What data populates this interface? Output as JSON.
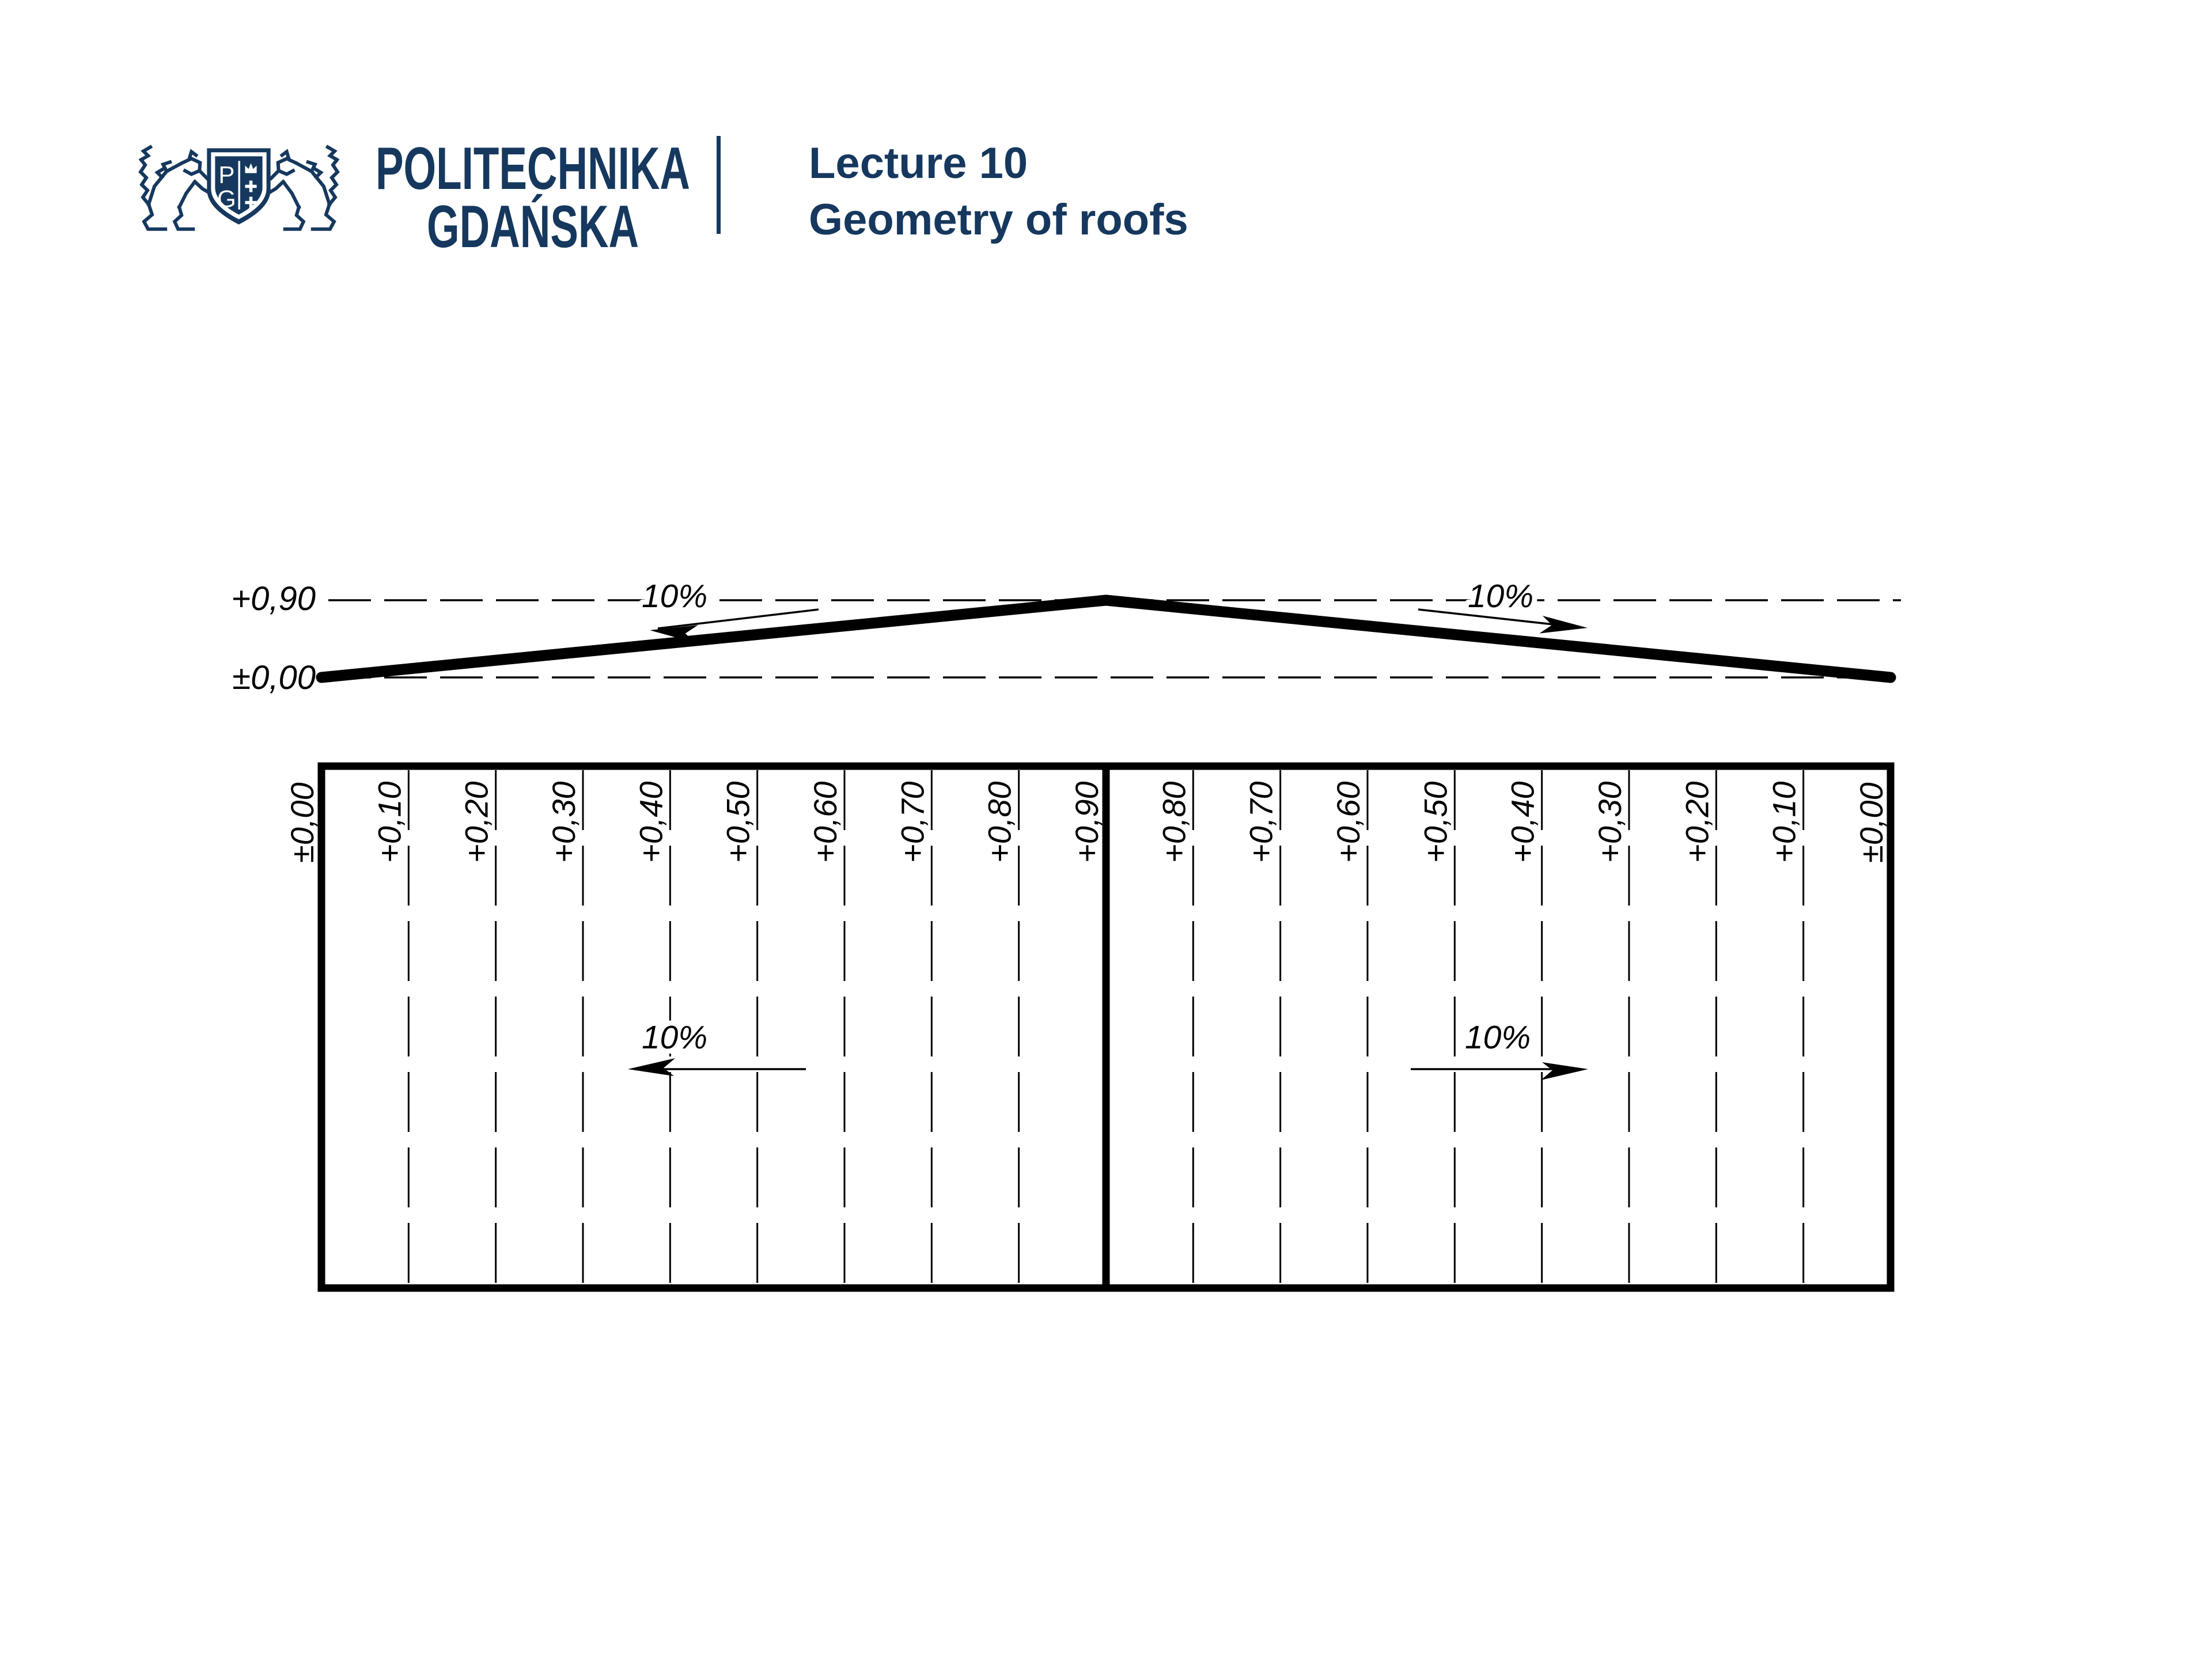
{
  "page": {
    "background": "#ffffff",
    "ink": "#000000"
  },
  "header": {
    "brand_color": "#16385e",
    "logo": {
      "letters": [
        "P",
        "G"
      ]
    },
    "university_name_line1": "POLITECHNIKA",
    "university_name_line2": "GDAŃSKA",
    "lecture_title": "Lecture 10",
    "lecture_subtitle": "Geometry of roofs"
  },
  "elevation": {
    "levels": {
      "ridge_label": "+0,90",
      "eave_label": "±0,00"
    },
    "slope_left": {
      "label": "10%",
      "direction": "down-left"
    },
    "slope_right": {
      "label": "10%",
      "direction": "down-right"
    }
  },
  "plan": {
    "contours": [
      "±0,00",
      "+0,10",
      "+0,20",
      "+0,30",
      "+0,40",
      "+0,50",
      "+0,60",
      "+0,70",
      "+0,80",
      "+0,90",
      "+0,80",
      "+0,70",
      "+0,60",
      "+0,50",
      "+0,40",
      "+0,30",
      "+0,20",
      "+0,10",
      "±0,00"
    ],
    "slope_left": {
      "label": "10%",
      "direction": "left"
    },
    "slope_right": {
      "label": "10%",
      "direction": "right"
    }
  }
}
